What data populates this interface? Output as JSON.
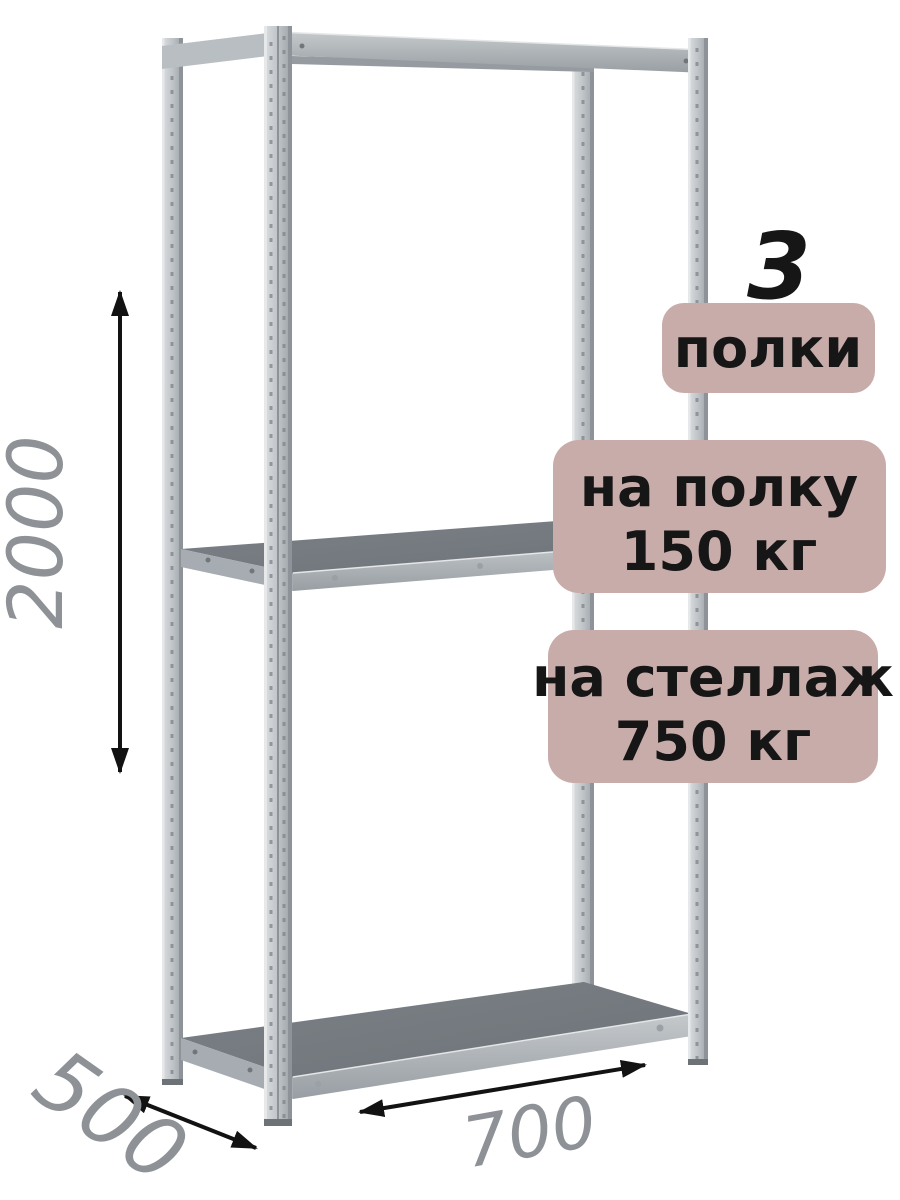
{
  "product": {
    "shelf_count": "3",
    "shelf_count_unit": "полки",
    "shelf_load": {
      "line1": "на полку",
      "line2": "150 кг"
    },
    "rack_load": {
      "line1": "на стеллаж",
      "line2": "750 кг"
    }
  },
  "dimensions": {
    "height": "2000",
    "depth": "500",
    "width": "700"
  },
  "colors": {
    "badge_bg": "#c8acaa",
    "badge_text": "#161616",
    "dimension_text": "#8e9296",
    "arrow": "#121212",
    "background": "#ffffff"
  }
}
